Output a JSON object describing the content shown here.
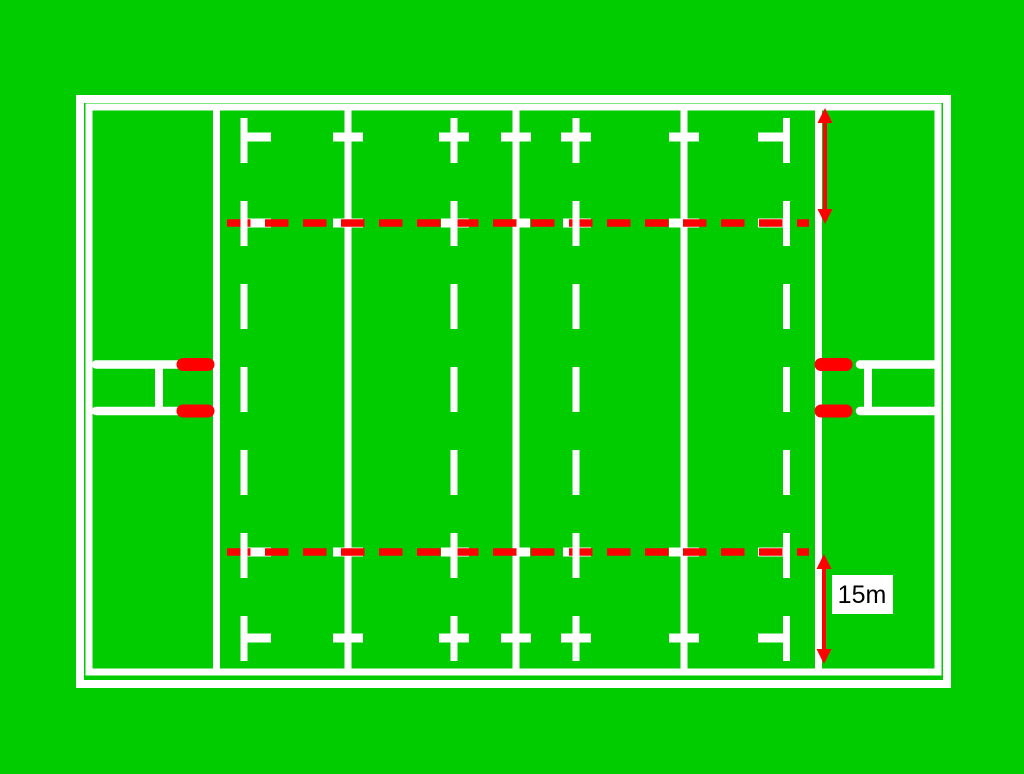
{
  "labels": {
    "distance": "15m"
  },
  "colors": {
    "grass": "#00cc00",
    "line": "#ffffff",
    "marking": "#ff0000",
    "label-bg": "#ffffff",
    "label-text": "#000000"
  }
}
